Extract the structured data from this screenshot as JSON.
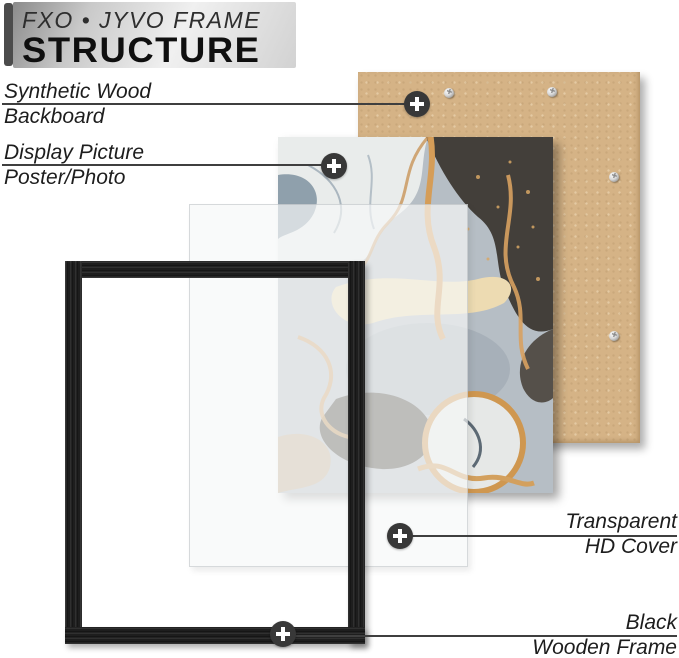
{
  "header": {
    "brand": "FXO • JYVO FRAME",
    "title": "STRUCTURE"
  },
  "callouts": {
    "backboard": {
      "line1": "Synthetic Wood",
      "line2": "Backboard"
    },
    "picture": {
      "line1": "Display Picture",
      "line2": "Poster/Photo"
    },
    "cover": {
      "line1": "Transparent",
      "line2": "HD Cover"
    },
    "frame": {
      "line1": "Black",
      "line2": "Wooden Frame"
    }
  },
  "icons": {
    "marker": "crosshair-plus",
    "screw": "phillips-screw"
  },
  "colors": {
    "backboard": "#d5b386",
    "frame": "#1e1e1e",
    "marker_circle": "#383838",
    "marker_plus": "#ffffff",
    "callout_line": "#3f3f3f",
    "header_gradient_dark": "#8b8b8b",
    "header_gradient_light": "#f0f0f0",
    "brand_bar": "#4c4c4c",
    "art_gold": "#d59d58",
    "art_dark": "#433f3a",
    "art_gray": "#b6bec5"
  }
}
